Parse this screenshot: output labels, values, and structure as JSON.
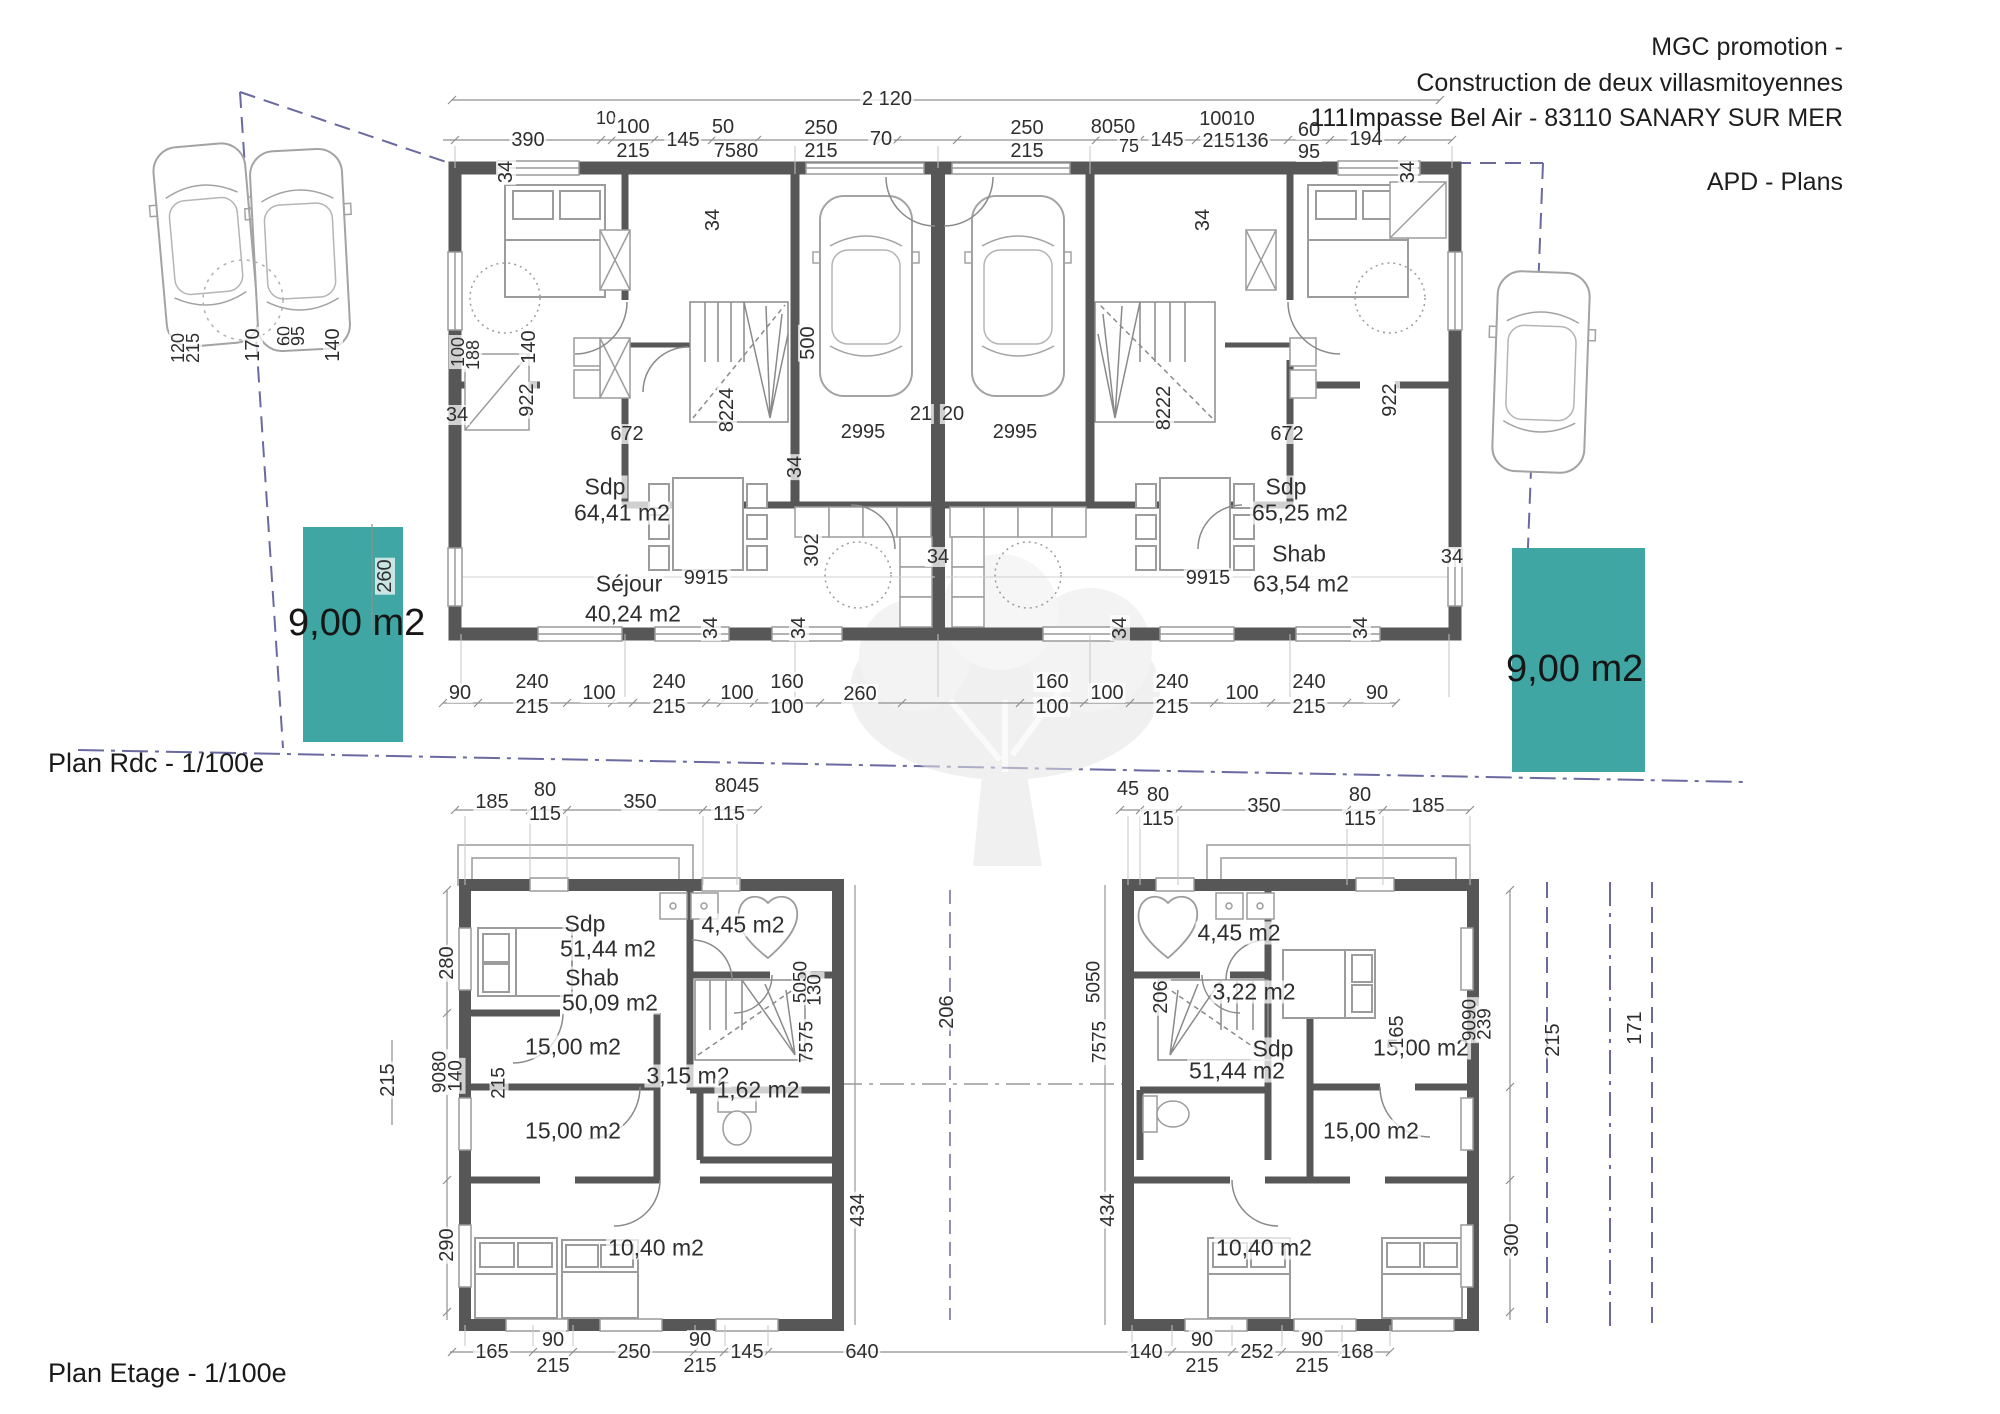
{
  "header": {
    "company": "MGC promotion -",
    "project": "Construction de deux villasmitoyennes",
    "address": "111Impasse Bel Air - 83110 SANARY SUR MER",
    "doc_type": "APD - Plans"
  },
  "colors": {
    "teal": "#3FA6A3",
    "wall": "#575757",
    "boundary": "#6a6aa0",
    "dim": "#8f8f8f"
  },
  "plan_rdc": {
    "caption": "Plan Rdc - 1/100e",
    "garden_left": "9,00 m2",
    "garden_right": "9,00 m2",
    "annotations": [
      {
        "t": "2 120",
        "x": 887,
        "y": 99
      },
      {
        "t": "390",
        "x": 528,
        "y": 140
      },
      {
        "t": "10",
        "x": 606,
        "y": 118,
        "s": 18
      },
      {
        "t": "100",
        "x": 633,
        "y": 127
      },
      {
        "t": "215",
        "x": 633,
        "y": 151
      },
      {
        "t": "145",
        "x": 683,
        "y": 140
      },
      {
        "t": "50",
        "x": 723,
        "y": 127
      },
      {
        "t": "7580",
        "x": 736,
        "y": 151
      },
      {
        "t": "250",
        "x": 821,
        "y": 128
      },
      {
        "t": "215",
        "x": 821,
        "y": 151
      },
      {
        "t": "70",
        "x": 881,
        "y": 139
      },
      {
        "t": "250",
        "x": 1027,
        "y": 128
      },
      {
        "t": "215",
        "x": 1027,
        "y": 151
      },
      {
        "t": "8050",
        "x": 1113,
        "y": 127
      },
      {
        "t": "75",
        "x": 1129,
        "y": 146,
        "s": 18
      },
      {
        "t": "145",
        "x": 1167,
        "y": 140
      },
      {
        "t": "10010",
        "x": 1227,
        "y": 119
      },
      {
        "t": "215",
        "x": 1219,
        "y": 141
      },
      {
        "t": "136",
        "x": 1252,
        "y": 141
      },
      {
        "t": "60",
        "x": 1309,
        "y": 130
      },
      {
        "t": "95",
        "x": 1309,
        "y": 152
      },
      {
        "t": "194",
        "x": 1366,
        "y": 139
      },
      {
        "t": "90",
        "x": 460,
        "y": 693
      },
      {
        "t": "240",
        "x": 532,
        "y": 682
      },
      {
        "t": "215",
        "x": 532,
        "y": 707
      },
      {
        "t": "100",
        "x": 599,
        "y": 693
      },
      {
        "t": "240",
        "x": 669,
        "y": 682
      },
      {
        "t": "215",
        "x": 669,
        "y": 707
      },
      {
        "t": "100",
        "x": 737,
        "y": 693
      },
      {
        "t": "160",
        "x": 787,
        "y": 682
      },
      {
        "t": "100",
        "x": 787,
        "y": 707
      },
      {
        "t": "260",
        "x": 860,
        "y": 694
      },
      {
        "t": "160",
        "x": 1052,
        "y": 682
      },
      {
        "t": "100",
        "x": 1052,
        "y": 707
      },
      {
        "t": "100",
        "x": 1107,
        "y": 693
      },
      {
        "t": "240",
        "x": 1172,
        "y": 682
      },
      {
        "t": "215",
        "x": 1172,
        "y": 707
      },
      {
        "t": "100",
        "x": 1242,
        "y": 693
      },
      {
        "t": "240",
        "x": 1309,
        "y": 682
      },
      {
        "t": "215",
        "x": 1309,
        "y": 707
      },
      {
        "t": "90",
        "x": 1377,
        "y": 693
      },
      {
        "t": "Sdp",
        "x": 605,
        "y": 487,
        "s": 23,
        "n": "room-label"
      },
      {
        "t": "64,41 m2",
        "x": 622,
        "y": 513,
        "s": 23,
        "n": "room-label"
      },
      {
        "t": "Séjour",
        "x": 629,
        "y": 584,
        "s": 23,
        "n": "room-label"
      },
      {
        "t": "40,24 m2",
        "x": 633,
        "y": 614,
        "s": 23,
        "n": "room-label"
      },
      {
        "t": "9915",
        "x": 706,
        "y": 578
      },
      {
        "t": "Sdp",
        "x": 1286,
        "y": 487,
        "s": 23,
        "n": "room-label"
      },
      {
        "t": "65,25 m2",
        "x": 1300,
        "y": 513,
        "s": 23,
        "n": "room-label"
      },
      {
        "t": "Shab",
        "x": 1299,
        "y": 554,
        "s": 23,
        "n": "room-label"
      },
      {
        "t": "63,54 m2",
        "x": 1301,
        "y": 584,
        "s": 23,
        "n": "room-label"
      },
      {
        "t": "9915",
        "x": 1208,
        "y": 578
      },
      {
        "t": "2995",
        "x": 863,
        "y": 432
      },
      {
        "t": "2995",
        "x": 1015,
        "y": 432
      },
      {
        "t": "672",
        "x": 627,
        "y": 434
      },
      {
        "t": "672",
        "x": 1287,
        "y": 434
      },
      {
        "t": "21",
        "x": 921,
        "y": 414
      },
      {
        "t": "20",
        "x": 953,
        "y": 414
      },
      {
        "t": "500",
        "x": 808,
        "y": 343,
        "r": -90
      },
      {
        "t": "8224",
        "x": 727,
        "y": 410,
        "r": -90
      },
      {
        "t": "8222",
        "x": 1164,
        "y": 408,
        "r": -90
      },
      {
        "t": "922",
        "x": 527,
        "y": 400,
        "r": -90
      },
      {
        "t": "922",
        "x": 1390,
        "y": 400,
        "r": -90
      },
      {
        "t": "140",
        "x": 529,
        "y": 347,
        "r": -90
      },
      {
        "t": "100",
        "x": 458,
        "y": 352,
        "r": -90,
        "s": 18
      },
      {
        "t": "188",
        "x": 473,
        "y": 355,
        "r": -90,
        "s": 18
      },
      {
        "t": "302",
        "x": 812,
        "y": 550,
        "r": -90
      },
      {
        "t": "260",
        "x": 385,
        "y": 576,
        "r": -90
      },
      {
        "t": "34",
        "x": 506,
        "y": 172,
        "r": -90
      },
      {
        "t": "34",
        "x": 713,
        "y": 220,
        "r": -90
      },
      {
        "t": "34",
        "x": 795,
        "y": 467,
        "r": -90
      },
      {
        "t": "34",
        "x": 1203,
        "y": 220,
        "r": -90
      },
      {
        "t": "34",
        "x": 1408,
        "y": 172,
        "r": -90
      },
      {
        "t": "34",
        "x": 711,
        "y": 628,
        "r": -90
      },
      {
        "t": "34",
        "x": 799,
        "y": 628,
        "r": -90
      },
      {
        "t": "34",
        "x": 1120,
        "y": 628,
        "r": -90
      },
      {
        "t": "34",
        "x": 1361,
        "y": 628,
        "r": -90
      },
      {
        "t": "34",
        "x": 457,
        "y": 415
      },
      {
        "t": "34",
        "x": 938,
        "y": 557
      },
      {
        "t": "34",
        "x": 1452,
        "y": 557
      },
      {
        "t": "120",
        "x": 178,
        "y": 348,
        "r": -90,
        "s": 18
      },
      {
        "t": "215",
        "x": 193,
        "y": 348,
        "r": -90,
        "s": 18
      },
      {
        "t": "170",
        "x": 253,
        "y": 345,
        "r": -90
      },
      {
        "t": "60",
        "x": 284,
        "y": 336,
        "r": -90,
        "s": 18
      },
      {
        "t": "95",
        "x": 298,
        "y": 336,
        "r": -90,
        "s": 18
      },
      {
        "t": "140",
        "x": 333,
        "y": 345,
        "r": -90
      }
    ]
  },
  "plan_etage": {
    "caption": "Plan Etage - 1/100e",
    "annotations": [
      {
        "t": "185",
        "x": 492,
        "y": 802
      },
      {
        "t": "80",
        "x": 545,
        "y": 790
      },
      {
        "t": "115",
        "x": 545,
        "y": 814
      },
      {
        "t": "350",
        "x": 640,
        "y": 802
      },
      {
        "t": "8045",
        "x": 737,
        "y": 786
      },
      {
        "t": "115",
        "x": 729,
        "y": 814
      },
      {
        "t": "45",
        "x": 1128,
        "y": 789
      },
      {
        "t": "80",
        "x": 1158,
        "y": 795
      },
      {
        "t": "115",
        "x": 1158,
        "y": 819
      },
      {
        "t": "350",
        "x": 1264,
        "y": 806
      },
      {
        "t": "80",
        "x": 1360,
        "y": 795
      },
      {
        "t": "115",
        "x": 1360,
        "y": 819
      },
      {
        "t": "185",
        "x": 1428,
        "y": 806
      },
      {
        "t": "165",
        "x": 492,
        "y": 1352
      },
      {
        "t": "90",
        "x": 553,
        "y": 1340
      },
      {
        "t": "215",
        "x": 553,
        "y": 1366
      },
      {
        "t": "250",
        "x": 634,
        "y": 1352
      },
      {
        "t": "90",
        "x": 700,
        "y": 1340
      },
      {
        "t": "215",
        "x": 700,
        "y": 1366
      },
      {
        "t": "145",
        "x": 747,
        "y": 1352
      },
      {
        "t": "640",
        "x": 862,
        "y": 1352
      },
      {
        "t": "140",
        "x": 1146,
        "y": 1352
      },
      {
        "t": "90",
        "x": 1202,
        "y": 1340
      },
      {
        "t": "215",
        "x": 1202,
        "y": 1366
      },
      {
        "t": "252",
        "x": 1257,
        "y": 1352
      },
      {
        "t": "90",
        "x": 1312,
        "y": 1340
      },
      {
        "t": "215",
        "x": 1312,
        "y": 1366
      },
      {
        "t": "168",
        "x": 1357,
        "y": 1352
      },
      {
        "t": "Sdp",
        "x": 585,
        "y": 924,
        "s": 23,
        "n": "room-label"
      },
      {
        "t": "51,44 m2",
        "x": 608,
        "y": 949,
        "s": 23,
        "n": "room-label"
      },
      {
        "t": "Shab",
        "x": 592,
        "y": 978,
        "s": 23,
        "n": "room-label"
      },
      {
        "t": "50,09 m2",
        "x": 610,
        "y": 1003,
        "s": 23,
        "n": "room-label"
      },
      {
        "t": "15,00 m2",
        "x": 573,
        "y": 1047,
        "s": 23,
        "n": "room-label"
      },
      {
        "t": "3,15 m2",
        "x": 688,
        "y": 1076,
        "s": 23,
        "n": "room-label"
      },
      {
        "t": "1,62 m2",
        "x": 758,
        "y": 1090,
        "s": 23,
        "n": "room-label"
      },
      {
        "t": "4,45 m2",
        "x": 743,
        "y": 925,
        "s": 23,
        "n": "room-label"
      },
      {
        "t": "15,00 m2",
        "x": 573,
        "y": 1131,
        "s": 23,
        "n": "room-label"
      },
      {
        "t": "10,40 m2",
        "x": 656,
        "y": 1248,
        "s": 23,
        "n": "room-label"
      },
      {
        "t": "4,45 m2",
        "x": 1239,
        "y": 933,
        "s": 23,
        "n": "room-label"
      },
      {
        "t": "3,22 m2",
        "x": 1254,
        "y": 992,
        "s": 23,
        "n": "room-label"
      },
      {
        "t": "Sdp",
        "x": 1273,
        "y": 1049,
        "s": 23,
        "n": "room-label"
      },
      {
        "t": "51,44 m2",
        "x": 1237,
        "y": 1071,
        "s": 23,
        "n": "room-label"
      },
      {
        "t": "15,00 m2",
        "x": 1421,
        "y": 1048,
        "s": 23,
        "n": "room-label"
      },
      {
        "t": "15,00 m2",
        "x": 1371,
        "y": 1131,
        "s": 23,
        "n": "room-label"
      },
      {
        "t": "10,40 m2",
        "x": 1264,
        "y": 1248,
        "s": 23,
        "n": "room-label"
      },
      {
        "t": "215",
        "x": 388,
        "y": 1080,
        "r": -90
      },
      {
        "t": "280",
        "x": 447,
        "y": 963,
        "r": -90
      },
      {
        "t": "9080",
        "x": 440,
        "y": 1072,
        "r": -90,
        "s": 19
      },
      {
        "t": "140",
        "x": 456,
        "y": 1076,
        "r": -90,
        "s": 19
      },
      {
        "t": "290",
        "x": 447,
        "y": 1245,
        "r": -90
      },
      {
        "t": "215",
        "x": 499,
        "y": 1083,
        "r": -90,
        "s": 19
      },
      {
        "t": "5050",
        "x": 801,
        "y": 982,
        "r": -90,
        "s": 19
      },
      {
        "t": "130",
        "x": 815,
        "y": 990,
        "r": -90,
        "s": 19
      },
      {
        "t": "7575",
        "x": 807,
        "y": 1042,
        "r": -90,
        "s": 19
      },
      {
        "t": "206",
        "x": 947,
        "y": 1012,
        "r": -90
      },
      {
        "t": "434",
        "x": 858,
        "y": 1210,
        "r": -90
      },
      {
        "t": "434",
        "x": 1108,
        "y": 1210,
        "r": -90
      },
      {
        "t": "5050",
        "x": 1094,
        "y": 982,
        "r": -90,
        "s": 19
      },
      {
        "t": "7575",
        "x": 1100,
        "y": 1042,
        "r": -90,
        "s": 19
      },
      {
        "t": "206",
        "x": 1161,
        "y": 997,
        "r": -90
      },
      {
        "t": "165",
        "x": 1397,
        "y": 1032,
        "r": -90
      },
      {
        "t": "9090",
        "x": 1470,
        "y": 1020,
        "r": -90,
        "s": 19
      },
      {
        "t": "239",
        "x": 1485,
        "y": 1024,
        "r": -90,
        "s": 19
      },
      {
        "t": "215",
        "x": 1553,
        "y": 1040,
        "r": -90
      },
      {
        "t": "171",
        "x": 1635,
        "y": 1028,
        "r": -90
      },
      {
        "t": "300",
        "x": 1512,
        "y": 1240,
        "r": -90
      }
    ]
  }
}
